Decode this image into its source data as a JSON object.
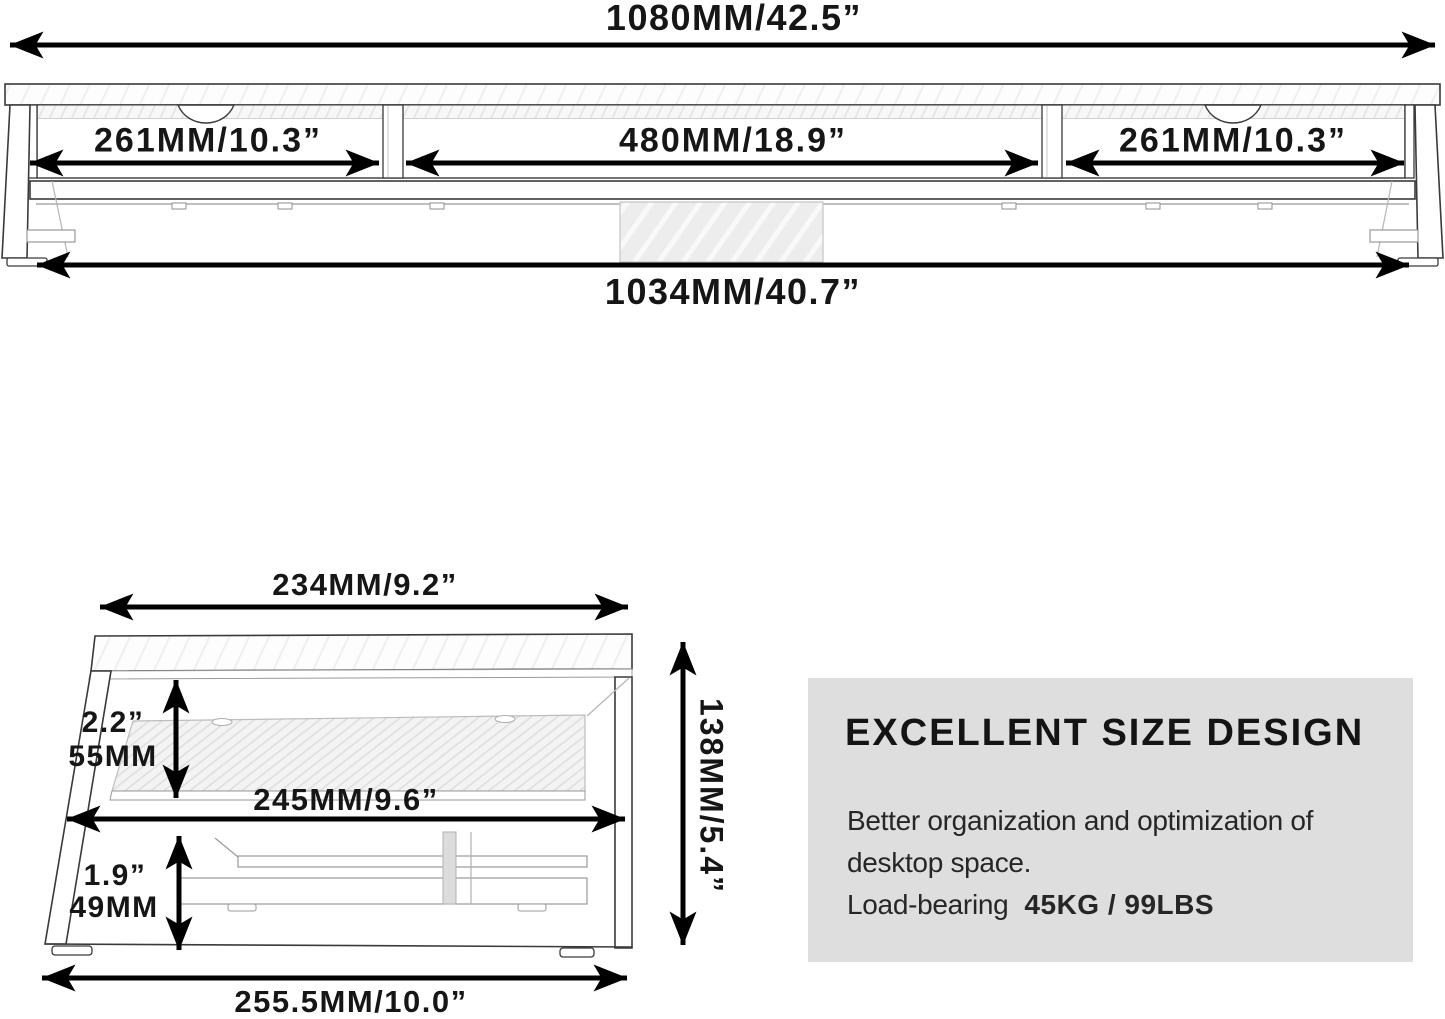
{
  "top_view": {
    "overall_width": "1080MM/42.5”",
    "left_section": "261MM/10.3”",
    "middle_section": "480MM/18.9”",
    "right_section": "261MM/10.3”",
    "base_width": "1034MM/40.7”"
  },
  "side_view": {
    "top_width": "234MM/9.2”",
    "upper_gap_in": "2.2”",
    "upper_gap_mm": "55MM",
    "middle_width": "245MM/9.6”",
    "lower_gap_in": "1.9”",
    "lower_gap_mm": "49MM",
    "bottom_width": "255.5MM/10.0”",
    "overall_height": "138MM/5.4”"
  },
  "info_box": {
    "title": "EXCELLENT SIZE DESIGN",
    "body_line1": "Better organization and optimization of",
    "body_line2": "desktop space.",
    "load_label": "Load-bearing",
    "load_value": "45KG / 99LBS",
    "bg_color": "#dedede",
    "text_color": "#262626"
  },
  "colors": {
    "arrow": "#000000",
    "outline": "#3a3a3a",
    "light_line": "#9a9a9a",
    "block_fill": "#ededed"
  }
}
